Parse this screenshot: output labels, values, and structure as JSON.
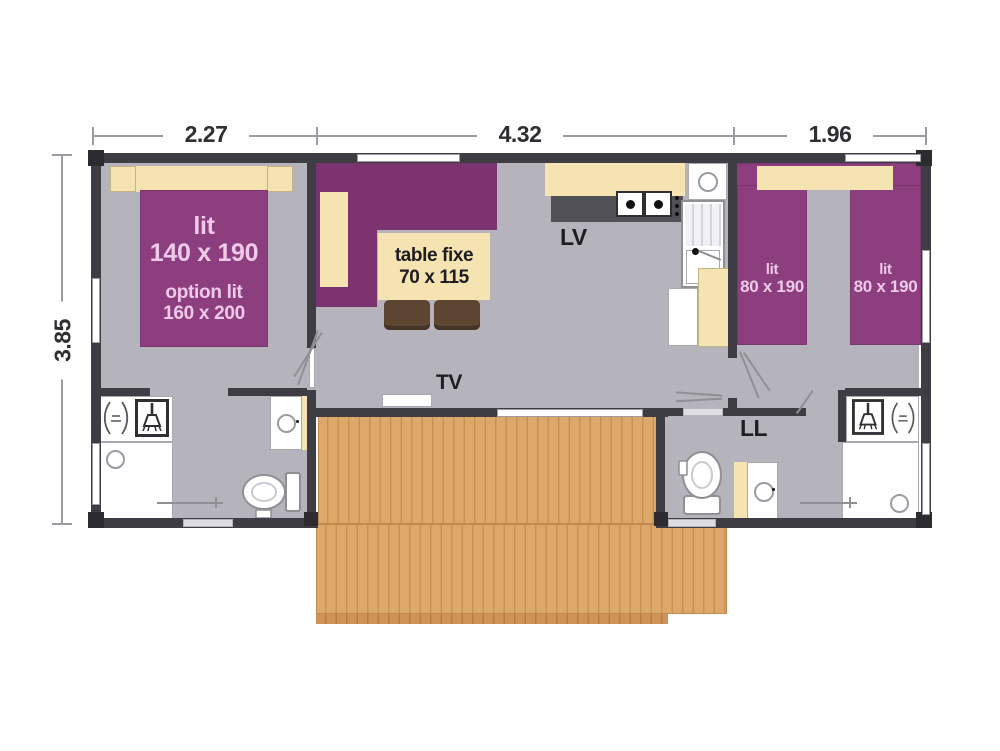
{
  "dimensions": {
    "top": [
      "2.27",
      "4.32",
      "1.96"
    ],
    "left": "3.85"
  },
  "master_bedroom": {
    "bed_type": "lit",
    "bed_size": "140 x 190",
    "option_type": "option lit",
    "option_size": "160 x 200"
  },
  "living_room": {
    "table_type": "table fixe",
    "table_size": "70 x 115",
    "tv": "TV"
  },
  "kitchen": {
    "dishwasher": "LV"
  },
  "utility": {
    "washing_machine": "LL"
  },
  "twin_bedroom": {
    "bed1_type": "lit",
    "bed1_size": "80 x 190",
    "bed2_type": "lit",
    "bed2_size": "80 x 190"
  },
  "icons": {
    "shower": "shower-icon",
    "shower_spray": "water-spray-icon",
    "toilet": "toilet-icon",
    "washbasin": "basin-circle",
    "washer_drum": "drum-circle",
    "cooktop": "two-burner-hob",
    "drain": "drain-circle"
  },
  "colors": {
    "wall": "#3e3d43",
    "floor": "#b5b4bc",
    "bed_purple": "#8c3e7f",
    "sofa_purple": "#7c3470",
    "furniture_cream": "#f5e3b2",
    "deck_wood": "#dca96a",
    "bed_label_pink": "#efc9e8",
    "label_dark": "#1d1d22"
  }
}
